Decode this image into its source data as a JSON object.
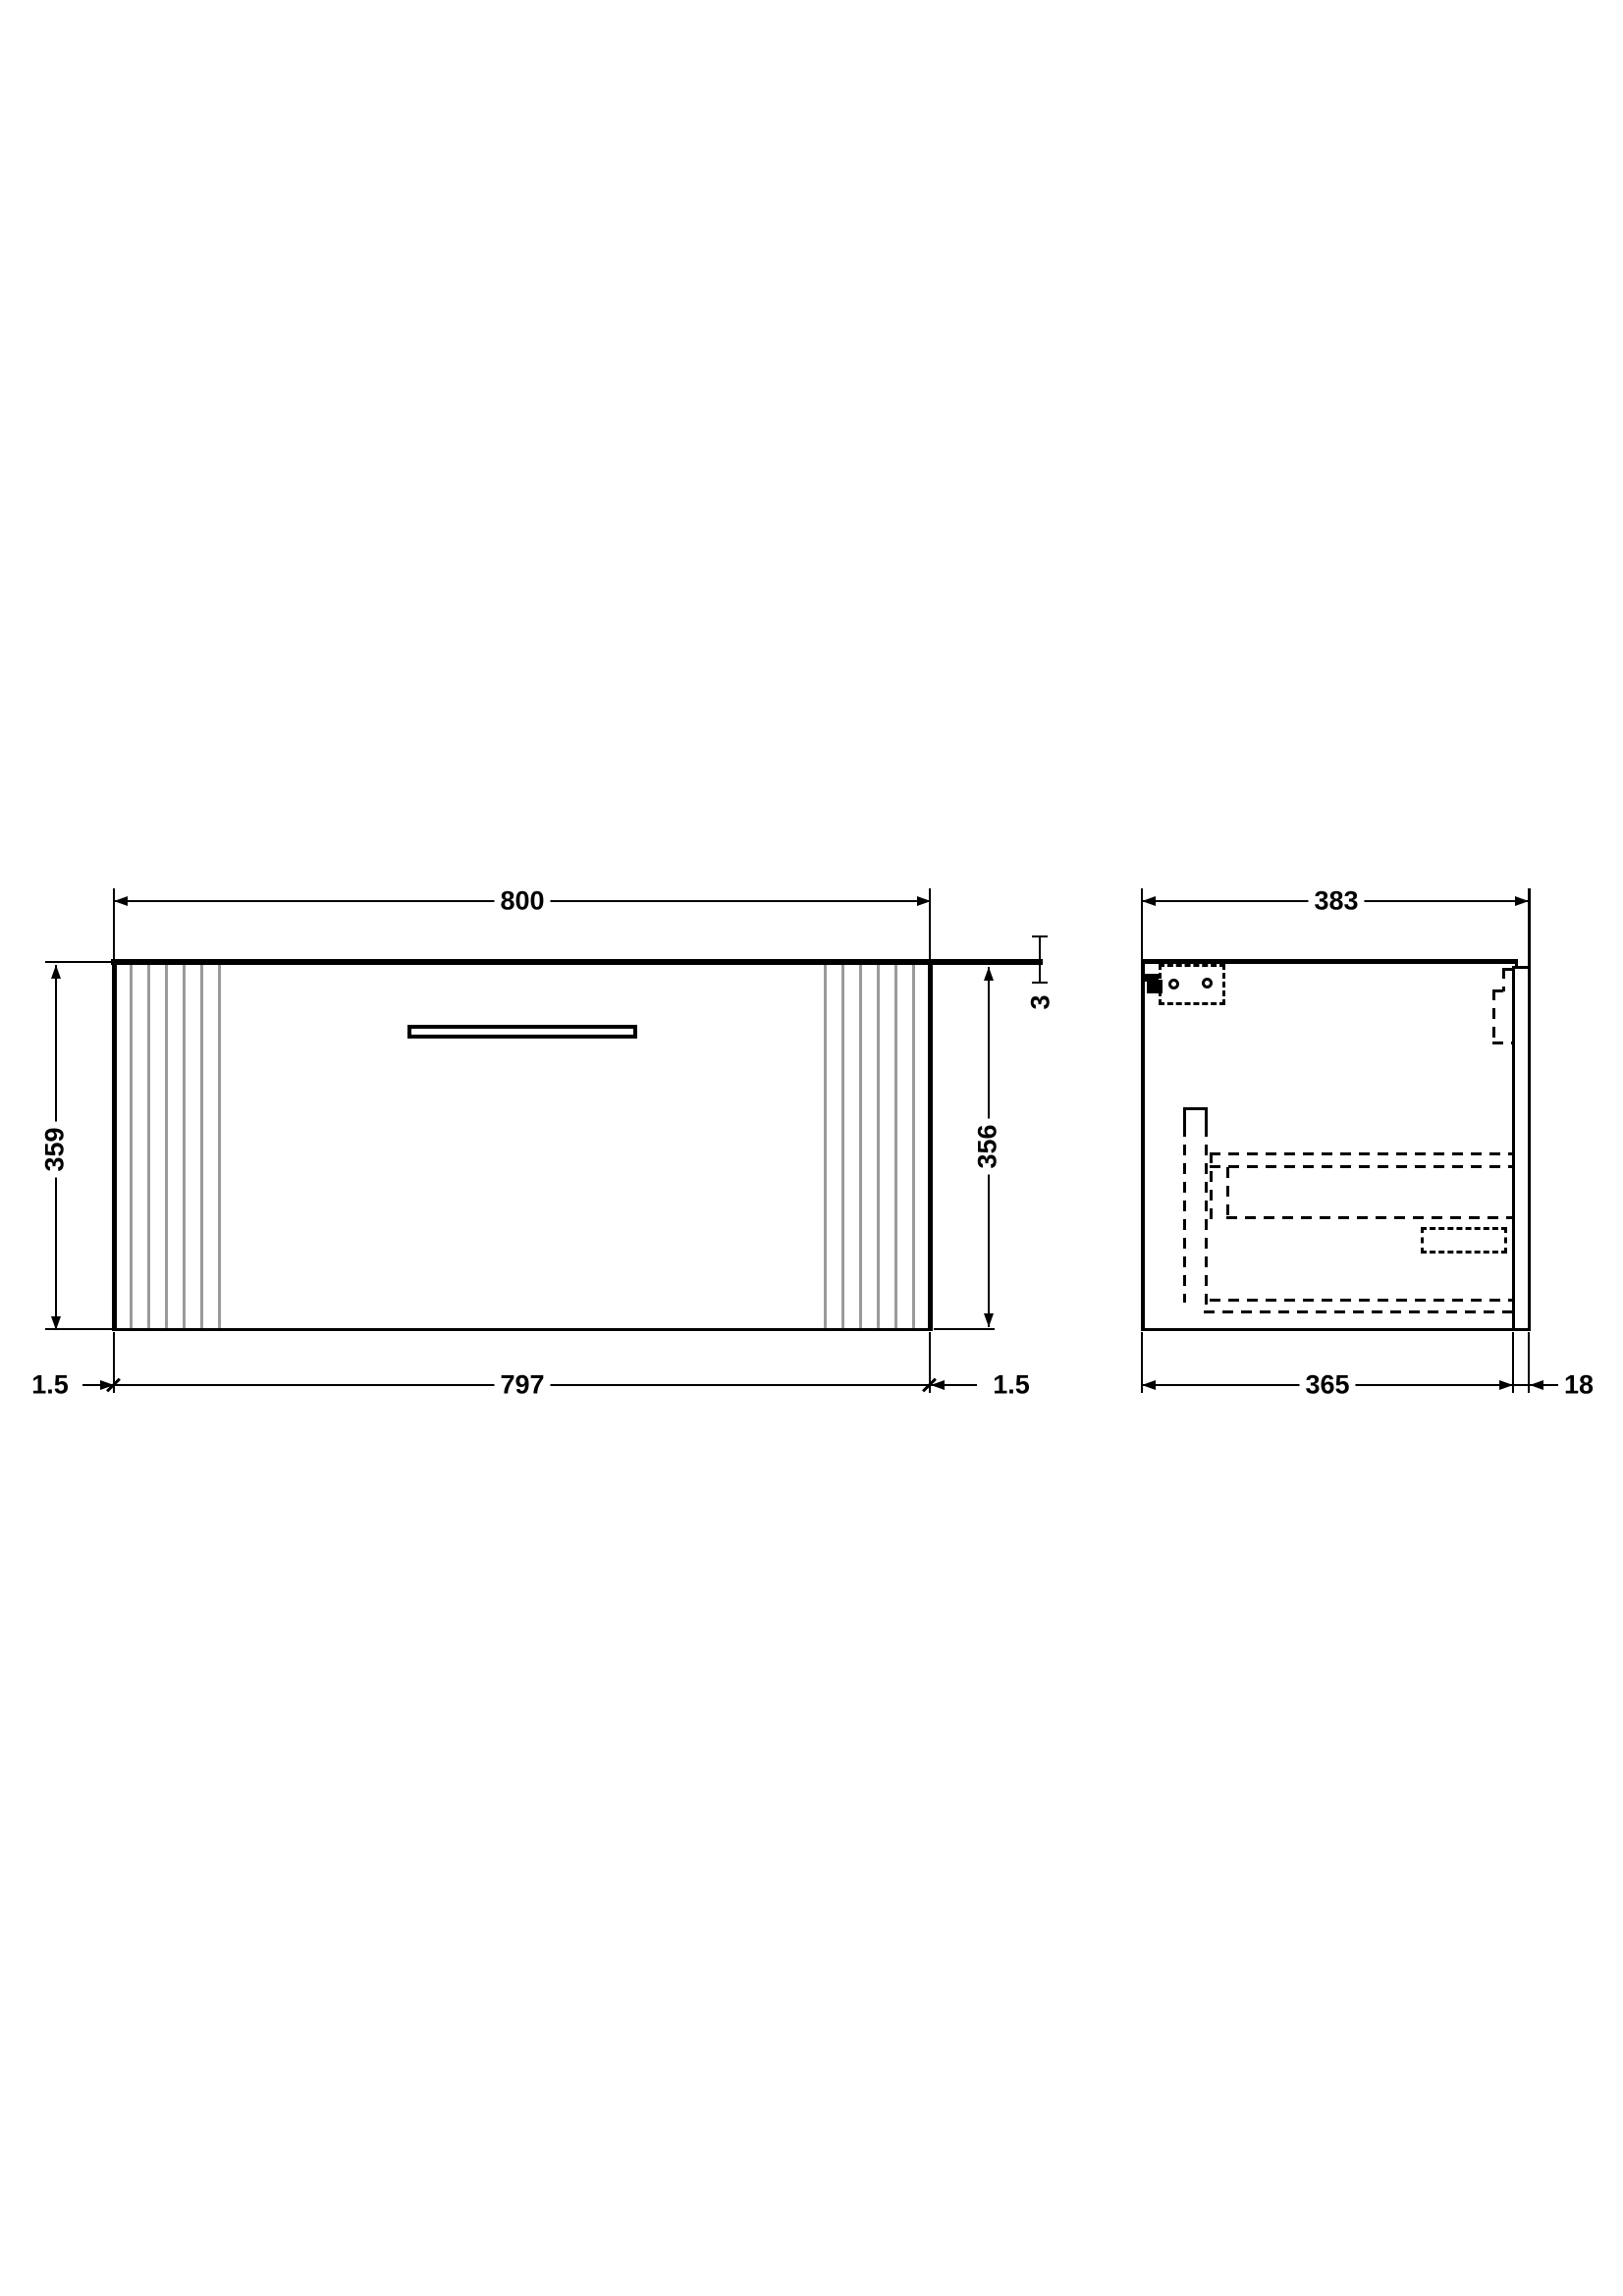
{
  "drawing": {
    "front_view": {
      "overall_width": "800",
      "overall_height": "359",
      "carcass_height": "356",
      "worktop_thickness": "3",
      "side_gap_left": "1.5",
      "carcass_width": "797",
      "side_gap_right": "1.5"
    },
    "side_view": {
      "overall_depth": "383",
      "carcass_depth": "365",
      "wall_rail_thickness": "18"
    },
    "colors": {
      "line": "#000000",
      "flute_line": "#9a9a9a",
      "background": "#ffffff"
    }
  }
}
